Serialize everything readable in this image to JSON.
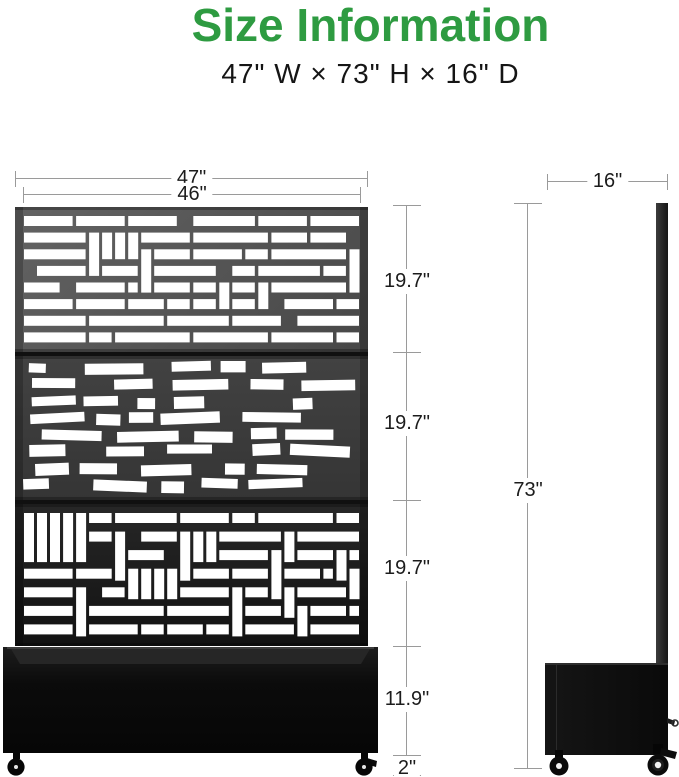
{
  "header": {
    "title": "Size Information",
    "subtitle": "47\" W × 73\" H × 16\" D"
  },
  "front_view": {
    "width_outer": "47\"",
    "width_inner": "46\"",
    "section_heights": [
      "19.7\"",
      "19.7\"",
      "19.7\""
    ],
    "planter_height": "11.9\"",
    "wheel_height": "2\""
  },
  "side_view": {
    "depth": "16\"",
    "total_height": "73\""
  },
  "colors": {
    "accent_green": "#2e9b41",
    "dimension_line": "#9a9a9a",
    "panel_dark": "#1a1a1a"
  }
}
